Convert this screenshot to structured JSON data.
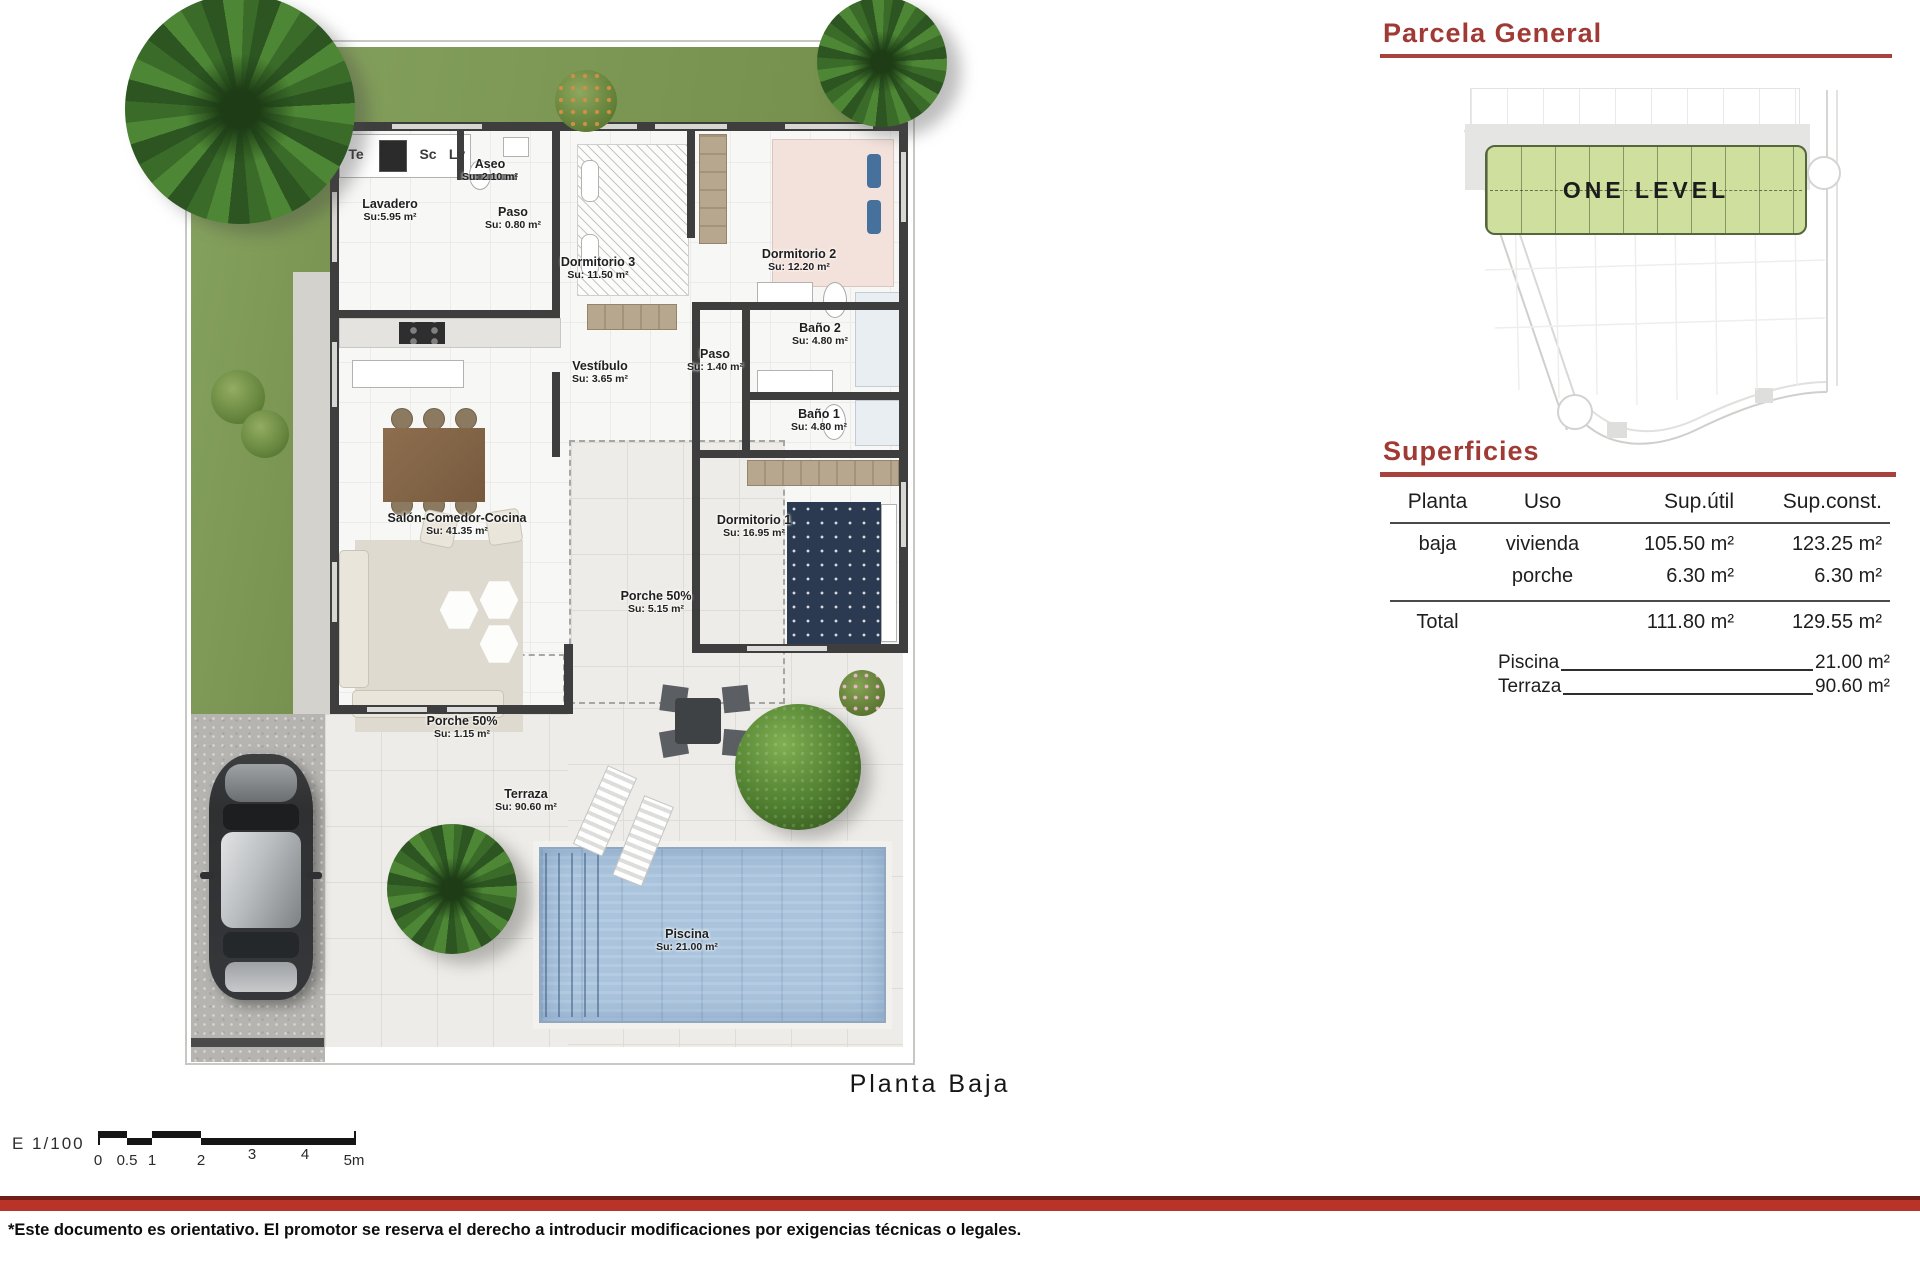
{
  "plan": {
    "caption": "Planta Baja",
    "kitchen": {
      "te": "Te",
      "sc": "Sc",
      "lv": "Lv"
    },
    "rooms": {
      "lavadero": {
        "name": "Lavadero",
        "area": "Su:5.95 m²"
      },
      "aseo": {
        "name": "Aseo",
        "area": "Su: 2.10 m²"
      },
      "paso1": {
        "name": "Paso",
        "area": "Su: 0.80 m²"
      },
      "dorm3": {
        "name": "Dormitorio 3",
        "area": "Su: 11.50 m²"
      },
      "dorm2": {
        "name": "Dormitorio 2",
        "area": "Su: 12.20 m²"
      },
      "bano2": {
        "name": "Baño 2",
        "area": "Su: 4.80 m²"
      },
      "paso2": {
        "name": "Paso",
        "area": "Su: 1.40 m²"
      },
      "vestibulo": {
        "name": "Vestíbulo",
        "area": "Su: 3.65 m²"
      },
      "bano1": {
        "name": "Baño 1",
        "area": "Su: 4.80 m²"
      },
      "dorm1": {
        "name": "Dormitorio 1",
        "area": "Su: 16.95 m²"
      },
      "salon": {
        "name": "Salón-Comedor-Cocina",
        "area": "Su: 41.35 m²"
      },
      "porche_salon": {
        "name": "Porche 50%",
        "area": "Su: 5.15 m²"
      },
      "porche_lateral": {
        "name": "Porche 50%",
        "area": "Su: 1.15 m²"
      },
      "terraza": {
        "name": "Terraza",
        "area": "Su: 90.60 m²"
      },
      "piscina": {
        "name": "Piscina",
        "area": "Su: 21.00 m²"
      }
    }
  },
  "parcela": {
    "title": "Parcela  General",
    "zone": "ONE LEVEL"
  },
  "superficies": {
    "title": "Superficies",
    "columns": [
      "Planta",
      "Uso",
      "Sup.útil",
      "Sup.const."
    ],
    "rows": [
      {
        "planta": "baja",
        "uso": "vivienda",
        "util": "105.50 m²",
        "const": "123.25 m²"
      },
      {
        "planta": "",
        "uso": "porche",
        "util": "6.30 m²",
        "const": "6.30 m²"
      }
    ],
    "total": {
      "label": "Total",
      "util": "111.80 m²",
      "const": "129.55 m²"
    },
    "extras": [
      {
        "label": "Piscina",
        "value": "21.00 m²"
      },
      {
        "label": "Terraza",
        "value": "90.60 m²"
      }
    ]
  },
  "scalebar": {
    "label": "E  1/100",
    "ticks": [
      "0",
      "0.5",
      "1",
      "2",
      "3",
      "4",
      "5m"
    ]
  },
  "footer": {
    "disclaimer": "*Este documento es orientativo. El promotor se reserva el derecho a introducir modificaciones por exigencias técnicas o legales."
  },
  "colors": {
    "accent_red": "#a8423c",
    "divider_red": "#b93428",
    "lawn_green": "#7f9b59",
    "parcel_green": "#cfe09e",
    "wall_dark": "#3e3e3e",
    "pool_blue": "#aac4dd"
  }
}
